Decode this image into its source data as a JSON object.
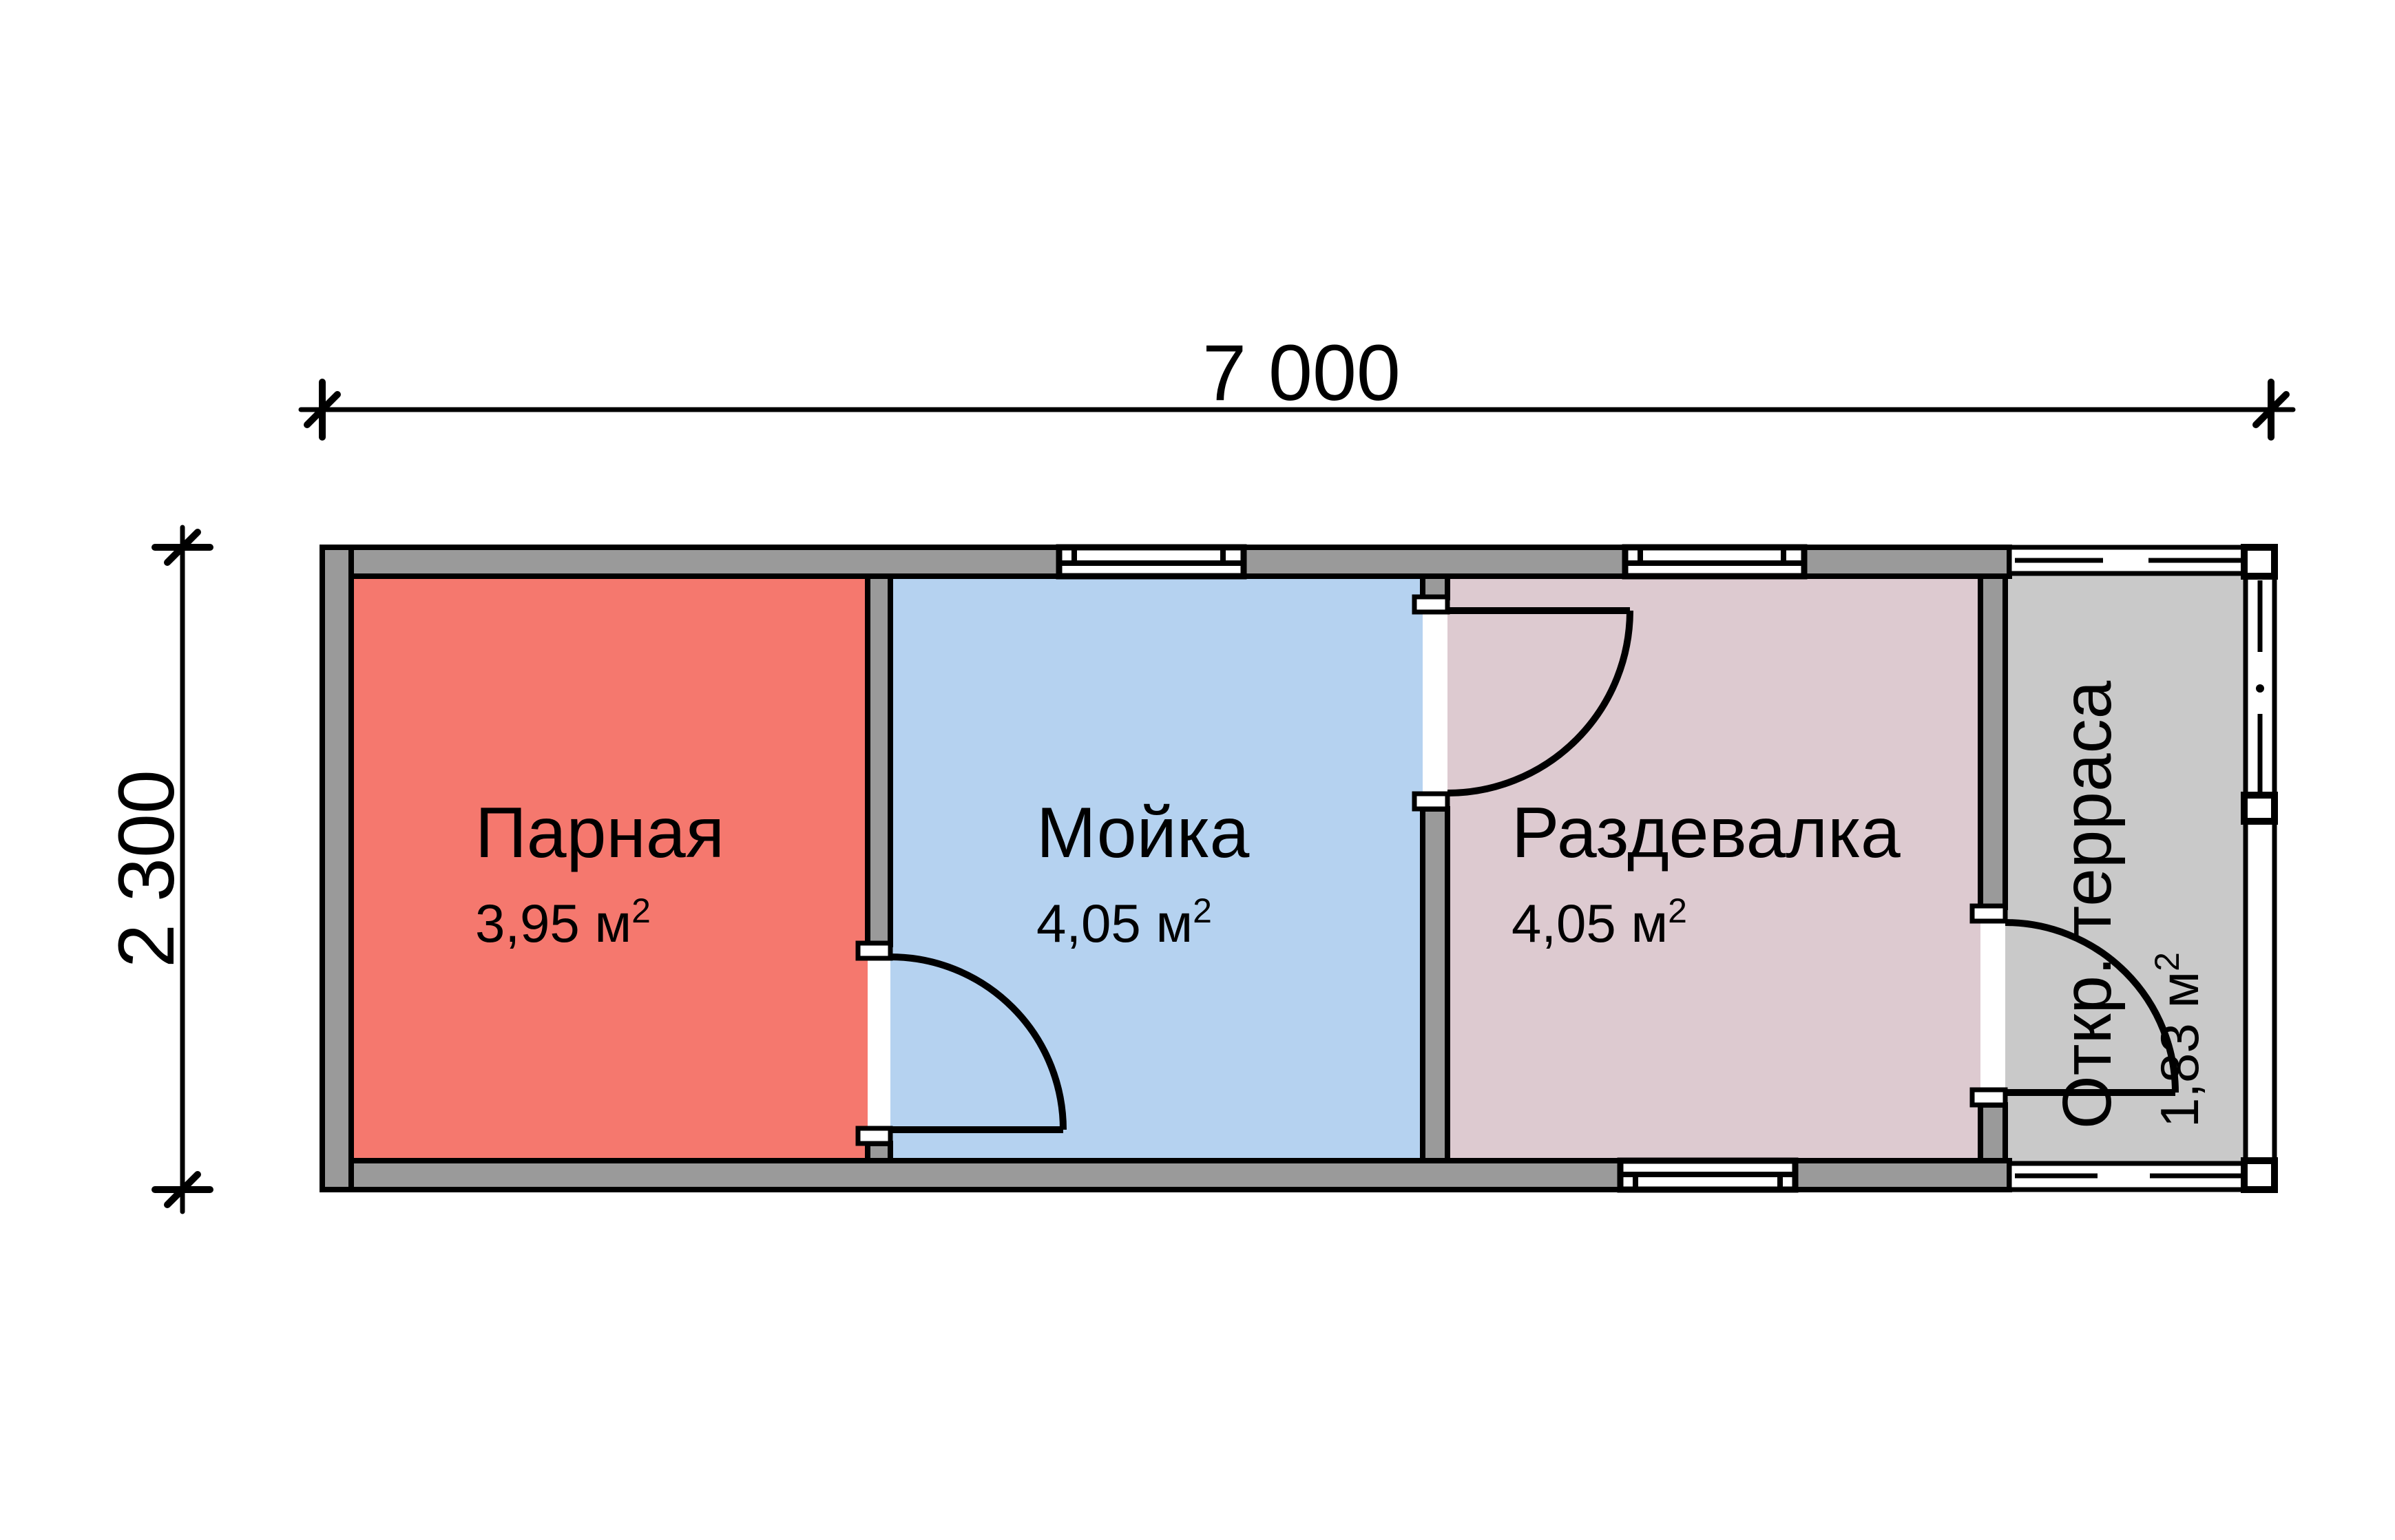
{
  "plan": {
    "dimensions": {
      "width_label": "7 000",
      "height_label": "2 300"
    },
    "rooms": [
      {
        "name": "Парная",
        "area_label": "3,95 м",
        "area_sup": "2",
        "color": "#f5786e"
      },
      {
        "name": "Мойка",
        "area_label": "4,05 м",
        "area_sup": "2",
        "color": "#b5d2f0"
      },
      {
        "name": "Раздевалка",
        "area_label": "4,05 м",
        "area_sup": "2",
        "color": "#ddcad0"
      },
      {
        "name": "Откр. терраса",
        "area_label": "1,83 м",
        "area_sup": "2",
        "color": "#c9c9c9"
      }
    ],
    "colors": {
      "wall": "#9a9a9a",
      "outline": "#000000",
      "background": "#ffffff",
      "window": "#ffffff"
    }
  }
}
